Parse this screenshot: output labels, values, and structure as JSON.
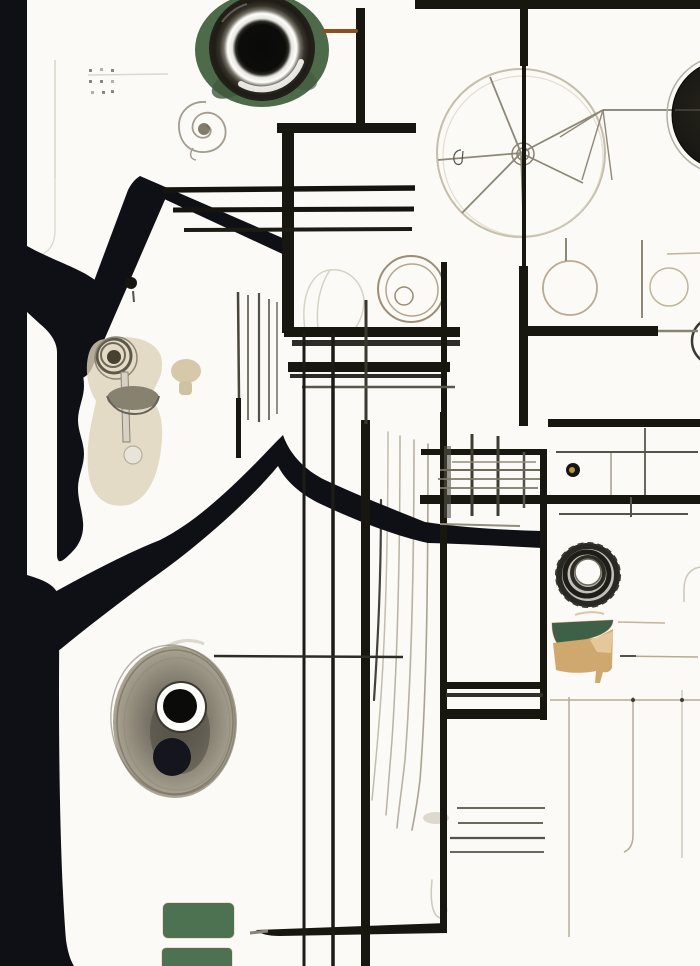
{
  "artwork": {
    "title": "Abstract ink schematic collage",
    "style": "blueprint-like sketch with photographic lens, coil, wheel and organic ink silhouette",
    "background": "#fbfaf6"
  },
  "palette": {
    "background": "#fbfaf6",
    "ink": "#0f1016",
    "line": "#17160f",
    "line_mid": "#3a372e",
    "gray": "#6b675c",
    "gray_light": "#8f8878",
    "faint": "#d8d3c8",
    "sketch": "#b2a78f",
    "sketch_warm": "#b8ab94",
    "green_blob": "#4e6b49",
    "green_blob_dark": "#3f5a3c",
    "green_wedge": "#3e6047",
    "green_rect": "#4d7251",
    "tan": "#cfa86f",
    "tan_light": "#e4c79b",
    "beige": "#ddd3ba",
    "taupe": "#948d7b",
    "taupe_dark": "#55514a",
    "brown": "#8f4e22",
    "gold": "#b8963f",
    "white": "#fdfdfb",
    "navy_dot": "#14151d"
  },
  "elements": {
    "camera_lens": {
      "desc": "dark lens barrel with white inner ring and black pupil, green painted fringe, top center",
      "fringe": "green_blob"
    },
    "right_disc": {
      "desc": "dark disc clipped at right edge with thin halo ring"
    },
    "spoked_wheel": {
      "desc": "faint sketched wheel with hub and radial spokes, top right of center"
    },
    "spiral_doodle": {
      "desc": "small pencil spiral scribble below the lens"
    },
    "dot_grid": {
      "desc": "tiny 3x3 dotted grid, top left"
    },
    "ink_silhouette": {
      "desc": "black organic trunk along the left edge with white slots and a chevron branch"
    },
    "line_grid": {
      "desc": "thick black orthogonal bars and thin sketch lines forming a schematic grid"
    },
    "string_lines": {
      "desc": "group of thin vertical sketch strings, center"
    },
    "hatch_grid": {
      "desc": "small cross-hatched radiator grid, center right"
    },
    "gold_eyelet": {
      "desc": "small dark ring with gold center beside hatch grid"
    },
    "coil": {
      "desc": "dark concentric coil with white center hole, lower right of center"
    },
    "green_wedge": {
      "desc": "flat green wedge under the coil"
    },
    "tan_wash": {
      "desc": "tan watercolor block under the green wedge"
    },
    "eye_blob": {
      "desc": "taupe scribbled blob with a white-ringed black eye and a plain dark circle, lower left"
    },
    "lamp_fixture": {
      "desc": "beige wash with knob, stem, gray bowl and small ball, middle left"
    },
    "mushroom": {
      "desc": "small beige mushroom shape beside the lamp"
    },
    "ink_dot": {
      "desc": "small black teardrop dot above the lamp"
    },
    "green_tiles": {
      "desc": "two green rounded rectangles at the bottom"
    },
    "sketch_circles": {
      "desc": "faint outlined circles in the upper middle band"
    },
    "brown_tick": {
      "desc": "short rust-brown horizontal stroke right of the lens"
    }
  }
}
